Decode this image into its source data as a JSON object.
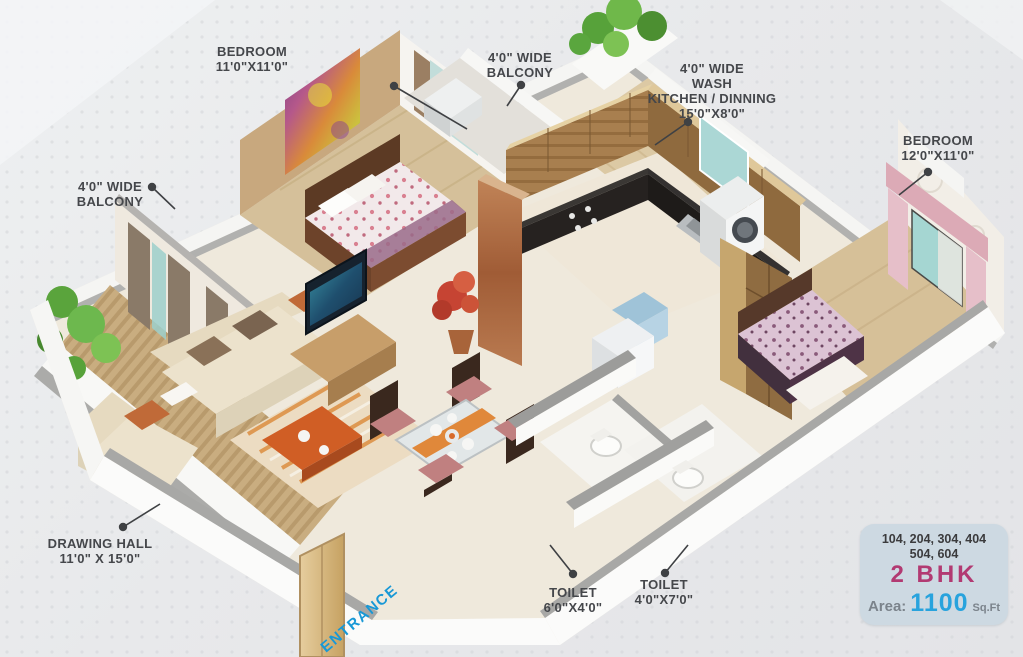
{
  "plan": {
    "type": "2 BHK apartment isometric floor plan",
    "labels": {
      "bedroom1": {
        "name": "BEDROOM",
        "size": "11'0\"X11'0\""
      },
      "balcony_top": {
        "line1": "4'0\" WIDE",
        "line2": "BALCONY"
      },
      "kitchen": {
        "line1": "4'0\" WIDE",
        "line2": "WASH",
        "line3": "KITCHEN / DINNING",
        "line4": "15'0\"X8'0\""
      },
      "bedroom2": {
        "name": "BEDROOM",
        "size": "12'0\"X11'0\""
      },
      "balcony_left": {
        "line1": "4'0\" WIDE",
        "line2": "BALCONY"
      },
      "drawing_hall": {
        "name": "DRAWING HALL",
        "size": "11'0\" X 15'0\""
      },
      "toilet1": {
        "name": "TOILET",
        "size": "6'0\"X4'0\""
      },
      "toilet2": {
        "name": "TOILET",
        "size": "4'0\"X7'0\""
      },
      "entrance": {
        "text": "ENTRANCE"
      }
    },
    "info_box": {
      "units_line1": "104, 204, 304, 404",
      "units_line2": "504, 604",
      "unit_type": "2 BHK",
      "area_label": "Area:",
      "area_value": "1100",
      "area_unit": "Sq.Ft"
    },
    "colors": {
      "background": "#e8e9eb",
      "label_text": "#45474b",
      "entrance_blue": "#1898d6",
      "bhk_magenta": "#b23a72",
      "area_blue": "#28a3dd",
      "info_box_bg": "#cdd9e2",
      "wood_floor": "#d5c09a",
      "wall_white": "#fbfbfa"
    }
  }
}
